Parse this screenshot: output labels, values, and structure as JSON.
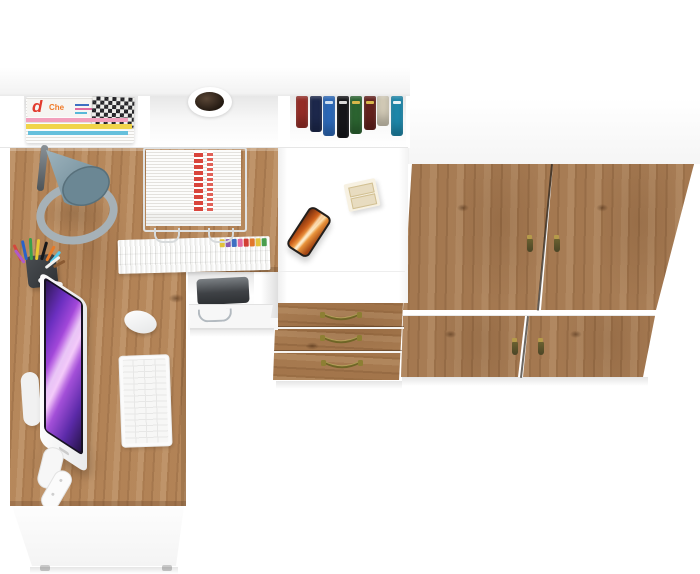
{
  "meta": {
    "description": "Top-down 3D product render of a home office furniture set: white corner desk with oak desktop, hutch shelves, drawer cabinet and a two-section oak wardrobe",
    "canvas": {
      "width": 700,
      "height": 574
    },
    "background": "#ffffff"
  },
  "palette": {
    "desk_wood": "#b28357",
    "wardrobe_wood": "#a37851",
    "drawer_wood": "#a2754b",
    "furniture_white": "#ffffff",
    "floor_shadow": "rgba(0,0,0,0.09)"
  },
  "hutch": {
    "magazines": {
      "top_spine_letter": "d",
      "top_spine_word": "Che",
      "letter_color": "#e23b2e",
      "word_color": "#f07a28",
      "stripe_colors": [
        "#f2a0bc",
        "#f0d44a",
        "#66c0dc"
      ]
    },
    "grommet": {
      "ring_color": "#ffffff",
      "hole_color": "#241a12"
    },
    "books": {
      "spines": [
        {
          "color": "#9e2f28",
          "h": 32
        },
        {
          "color": "#1e2a50",
          "h": 36
        },
        {
          "color": "#2e6ec2",
          "h": 40,
          "label": "#cfe0f2"
        },
        {
          "color": "#16171b",
          "h": 42,
          "label": "#d8d8d8"
        },
        {
          "color": "#2e6a33",
          "h": 38,
          "label": "#d9b64a"
        },
        {
          "color": "#6a231f",
          "h": 34,
          "label": "#d9b64a"
        },
        {
          "color": "#ded6c1",
          "h": 30
        },
        {
          "color": "#1f8fb4",
          "h": 40,
          "label": "#e6f2f6"
        }
      ]
    }
  },
  "desk": {
    "monitor": {
      "frame": "#f4f5f6",
      "bezel": "#171223",
      "screen_theme": "purple-galaxy"
    },
    "keyboard": {
      "body": "#fbfbfb",
      "key_line": "#e7e7e6"
    },
    "mouse": {
      "body": "#ffffff"
    },
    "lamp": {
      "shade_dark": "#64808c",
      "shade_light": "#9db3bd",
      "base_ring": "#a6b1b7",
      "arm": "#5a6166"
    },
    "pen_cup": {
      "cup": "#3a3e42",
      "pens": [
        {
          "color": "#d4483c",
          "x": 20,
          "y": 243,
          "h": 18,
          "rot": -25
        },
        {
          "color": "#2a62c8",
          "x": 25,
          "y": 240,
          "h": 20,
          "rot": -12
        },
        {
          "color": "#3ba04a",
          "x": 30,
          "y": 238,
          "h": 22,
          "rot": -3
        },
        {
          "color": "#e8c832",
          "x": 35,
          "y": 239,
          "h": 21,
          "rot": 6
        },
        {
          "color": "#17181a",
          "x": 40,
          "y": 241,
          "h": 19,
          "rot": 16
        },
        {
          "color": "#e87a28",
          "x": 45,
          "y": 244,
          "h": 17,
          "rot": 28
        },
        {
          "color": "#58c8e8",
          "x": 49,
          "y": 248,
          "h": 15,
          "rot": 40
        },
        {
          "color": "#b05ac8",
          "x": 23,
          "y": 247,
          "h": 16,
          "rot": -36
        },
        {
          "color": "#f2f2f0",
          "x": 44,
          "y": 250,
          "h": 18,
          "rot": 52
        },
        {
          "color": "#8a5a32",
          "x": 52,
          "y": 254,
          "h": 13,
          "rot": 62
        }
      ]
    },
    "paper_tray": {
      "wire": "#e0e2e3",
      "paper": "#ffffff",
      "stripe": "#d9453c"
    },
    "folders": {
      "tab_colors": [
        "#e3c23c",
        "#8a5bb0",
        "#3e6fc2",
        "#e06aa0",
        "#d23f34",
        "#e2782c",
        "#e3c23c",
        "#4a9e4e"
      ]
    },
    "printer": {
      "body": "#3f4246"
    },
    "under_drawer_handle": "#b3bac0"
  },
  "cabinet": {
    "phone": {
      "frame": "#241f1c",
      "screen_theme": "orange-canyon"
    },
    "notepad": {
      "body": "#f7f1e2",
      "slots": "#e8dcc0"
    }
  },
  "drawer_unit": {
    "handle_color": "#6f6526",
    "handle_cap": "#8d7f33",
    "drawers": [
      {
        "handle_x": 320,
        "handle_y": 311
      },
      {
        "handle_x": 320,
        "handle_y": 334
      },
      {
        "handle_x": 321,
        "handle_y": 359
      }
    ]
  },
  "wardrobe": {
    "tassel_body": "#4a4526",
    "tassel_cap": "#b59a4a",
    "tassel_handles": [
      {
        "x": 526,
        "y": 235
      },
      {
        "x": 553,
        "y": 235
      },
      {
        "x": 511,
        "y": 338
      },
      {
        "x": 537,
        "y": 338
      }
    ]
  }
}
